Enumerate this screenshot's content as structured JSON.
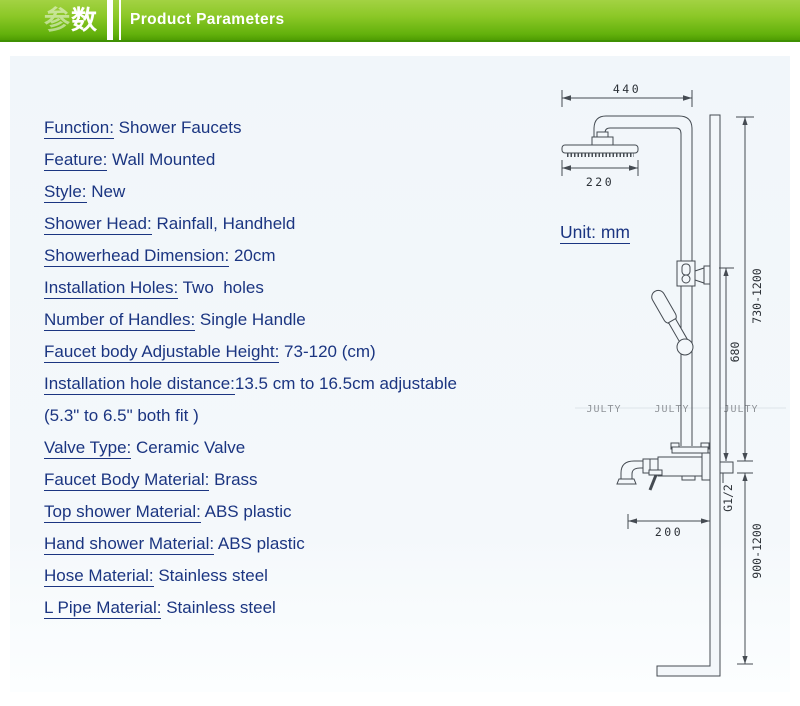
{
  "header": {
    "badge_char1": "参",
    "badge_char2": "数",
    "title": "Product Parameters"
  },
  "specs": [
    {
      "label": "Function:",
      "value": " Shower Faucets"
    },
    {
      "label": "Feature:",
      "value": " Wall Mounted"
    },
    {
      "label": "Style:",
      "value": " New"
    },
    {
      "label": "Shower Head:",
      "value": " Rainfall, Handheld"
    },
    {
      "label": "Showerhead Dimension:",
      "value": " 20cm"
    },
    {
      "label": "Installation Holes:",
      "value": " Two  holes"
    },
    {
      "label": "Number of Handles:",
      "value": " Single Handle"
    },
    {
      "label": "Faucet body Adjustable Height:",
      "value": " 73-120 (cm)"
    },
    {
      "label": "Installation hole distance:",
      "value": "13.5 cm to 16.5cm adjustable"
    },
    {
      "label": "",
      "value": "(5.3\" to 6.5\" both fit )"
    },
    {
      "label": "Valve Type:",
      "value": " Ceramic Valve"
    },
    {
      "label": "Faucet Body Material:",
      "value": " Brass"
    },
    {
      "label": "Top shower Material:",
      "value": " ABS plastic"
    },
    {
      "label": "Hand shower Material:",
      "value": " ABS plastic"
    },
    {
      "label": "Hose Material:",
      "value": " Stainless steel"
    },
    {
      "label": "L Pipe Material:",
      "value": " Stainless steel"
    }
  ],
  "diagram": {
    "unit_text": "Unit: mm",
    "overhead_arm_width": "440",
    "showerhead_width": "220",
    "bar_top_height": "730-1200",
    "slide_bar_length": "680",
    "thread_size": "G1/2",
    "spout_reach": "200",
    "install_height": "900-1200",
    "watermark": "JULTY"
  },
  "colors": {
    "header_green_top": "#8cc827",
    "header_green_bottom": "#4f9d03",
    "spec_text_navy": "#1b3581",
    "drawing_line": "#454b52",
    "panel_bg": "#f4f8fb"
  }
}
